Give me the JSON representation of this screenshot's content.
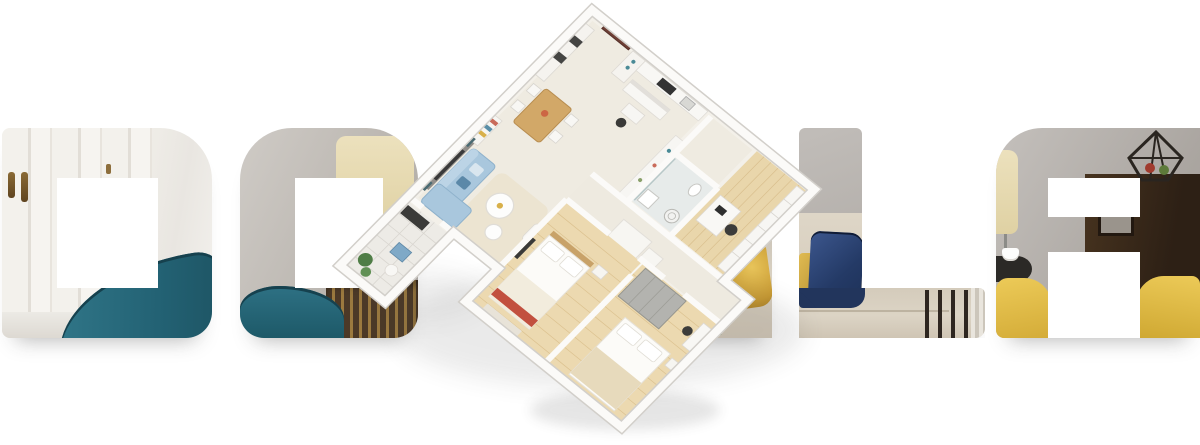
{
  "banner": {
    "background_color": "#ffffff",
    "description": "Hero banner: interior photos masked inside large letterforms with a 3D isometric apartment floor plan rotated over the center"
  },
  "letters": {
    "items": [
      {
        "glyph": "D",
        "photo_content": "white wardrobe doors with brass pulls, teal armchair"
      },
      {
        "glyph": "O",
        "photo_content": "grey wall, cream floor-lamp shade, teal armchair, dark slatted wardrobe"
      },
      {
        "glyph": "(partially hidden letter)",
        "photo_content": "gold satin pillow, beige sofa, green plant leaves"
      },
      {
        "glyph": "L",
        "photo_content": "navy velvet pillow, gold pillow, beige bedding, dark side-table legs"
      },
      {
        "glyph": "A",
        "photo_content": "cream lamp shade, dark wood cabinet, geometric lantern, coffee cup on black side table, yellow armchairs"
      }
    ]
  },
  "floorplan": {
    "view": "3d isometric, rotated about 42 degrees",
    "rooms": [
      {
        "name": "entry",
        "features": [
          "brown front door",
          "white wardrobe with dark niches",
          "desk with black chair"
        ]
      },
      {
        "name": "kitchen",
        "features": [
          "white counters",
          "black cooktop",
          "island",
          "pantry shelf"
        ]
      },
      {
        "name": "living-dining",
        "features": [
          "light blue L-sofa",
          "grey accent wall with framed art",
          "round white coffee tables",
          "dining table with four chairs",
          "bookshelf",
          "cream rug"
        ]
      },
      {
        "name": "bathroom",
        "features": [
          "glass shower",
          "toilet",
          "sink",
          "washer"
        ]
      },
      {
        "name": "study",
        "features": [
          "long white shelving wall",
          "desk",
          "black chair",
          "light wood floor"
        ]
      },
      {
        "name": "bedroom-1",
        "features": [
          "double bed with white bedding",
          "red throw",
          "white wardrobe volumes",
          "wall TV",
          "wood floor"
        ]
      },
      {
        "name": "bedroom-2",
        "features": [
          "double bed with beige blanket",
          "grey wardrobe",
          "bedside table",
          "desk with chair",
          "wood floor"
        ]
      },
      {
        "name": "balcony",
        "features": [
          "large tiled floor",
          "potted plants",
          "blue stool",
          "dark media bench"
        ]
      }
    ]
  },
  "colors": {
    "teal_armchair": "#2a6a7c",
    "sofa_blue": "#a6c6db",
    "navy_pillow": "#243a66",
    "gold_pillow": "#c9a23e",
    "yellow_armchair": "#e3c24f",
    "wood_floor": "#e9d6ab",
    "door_brown": "#6e3f35",
    "dark_cabinet": "#34261b",
    "wall_grey": "#b5b1ad"
  }
}
